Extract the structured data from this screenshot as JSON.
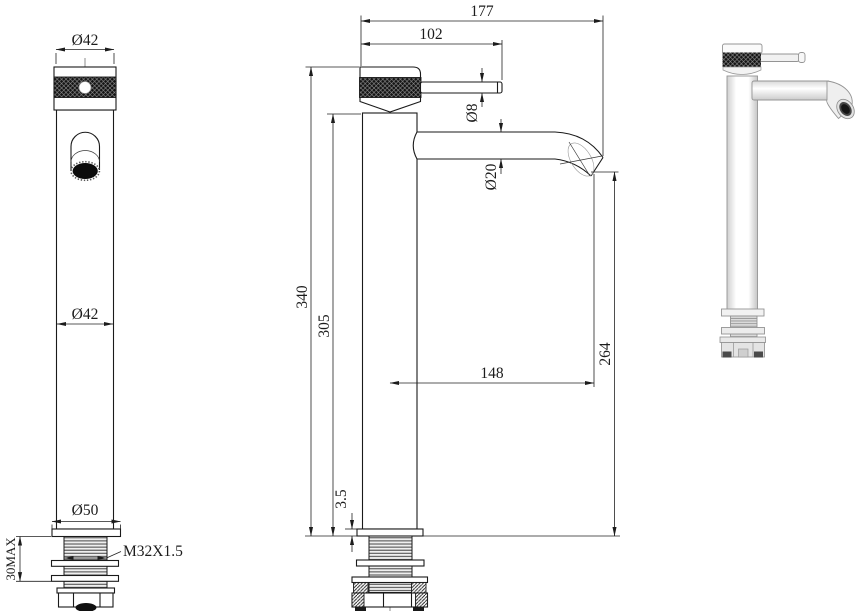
{
  "drawing": {
    "background": "#ffffff",
    "line_color": "#1a1a1a",
    "front": {
      "top_diameter": "Ø42",
      "body_diameter": "Ø42",
      "base_diameter": "Ø50",
      "max_mounting_thickness": "30MAX",
      "thread_spec": "M32X1.5"
    },
    "side": {
      "overall_reach": "177",
      "handle_reach": "102",
      "lever_diameter": "Ø8",
      "spout_diameter": "Ø20",
      "overall_height": "340",
      "body_height": "305",
      "spout_projection": "148",
      "outlet_height": "264",
      "flange_thickness": "3.5"
    }
  }
}
